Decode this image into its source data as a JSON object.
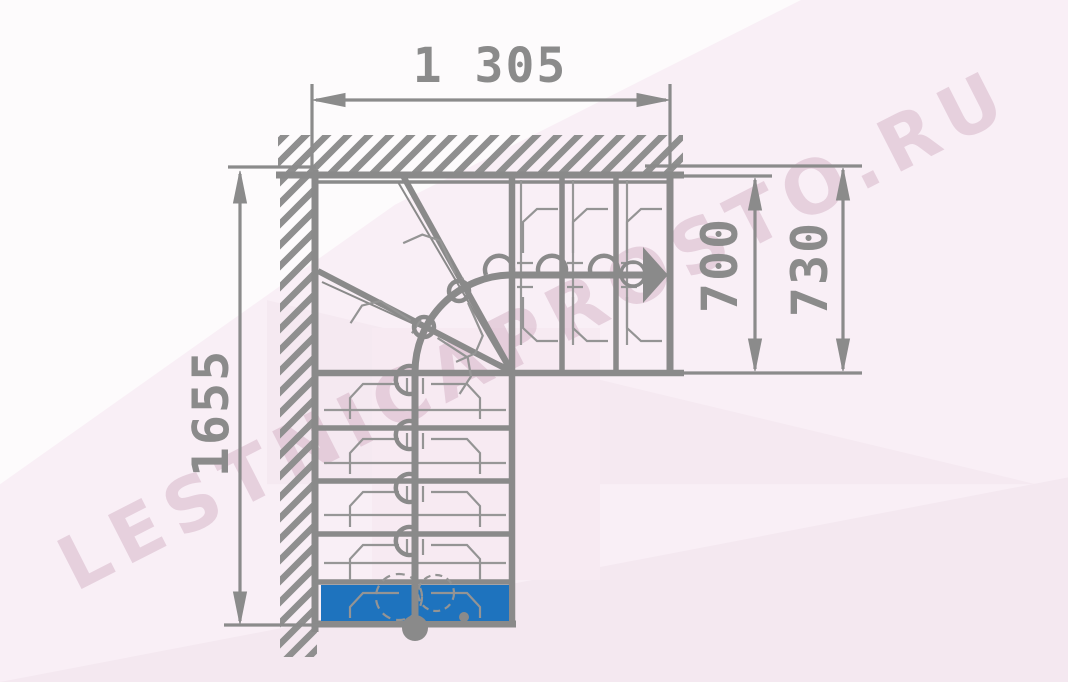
{
  "dimensions": {
    "width_top": "1 305",
    "going_width": "700",
    "going_width_outer": "730",
    "total_run": "1655"
  },
  "watermark": {
    "text": "LESTNICAPROSTO.RU"
  },
  "colors": {
    "drawing_line": "#8a8a8a",
    "first_step_highlight": "#1e73be",
    "background_tint": "#f8eef5",
    "watermark_tint": "#ecd9e4"
  },
  "icons": {
    "walk_direction_arrow": "right-triangle",
    "walk_start_marker": "filled-circle"
  }
}
